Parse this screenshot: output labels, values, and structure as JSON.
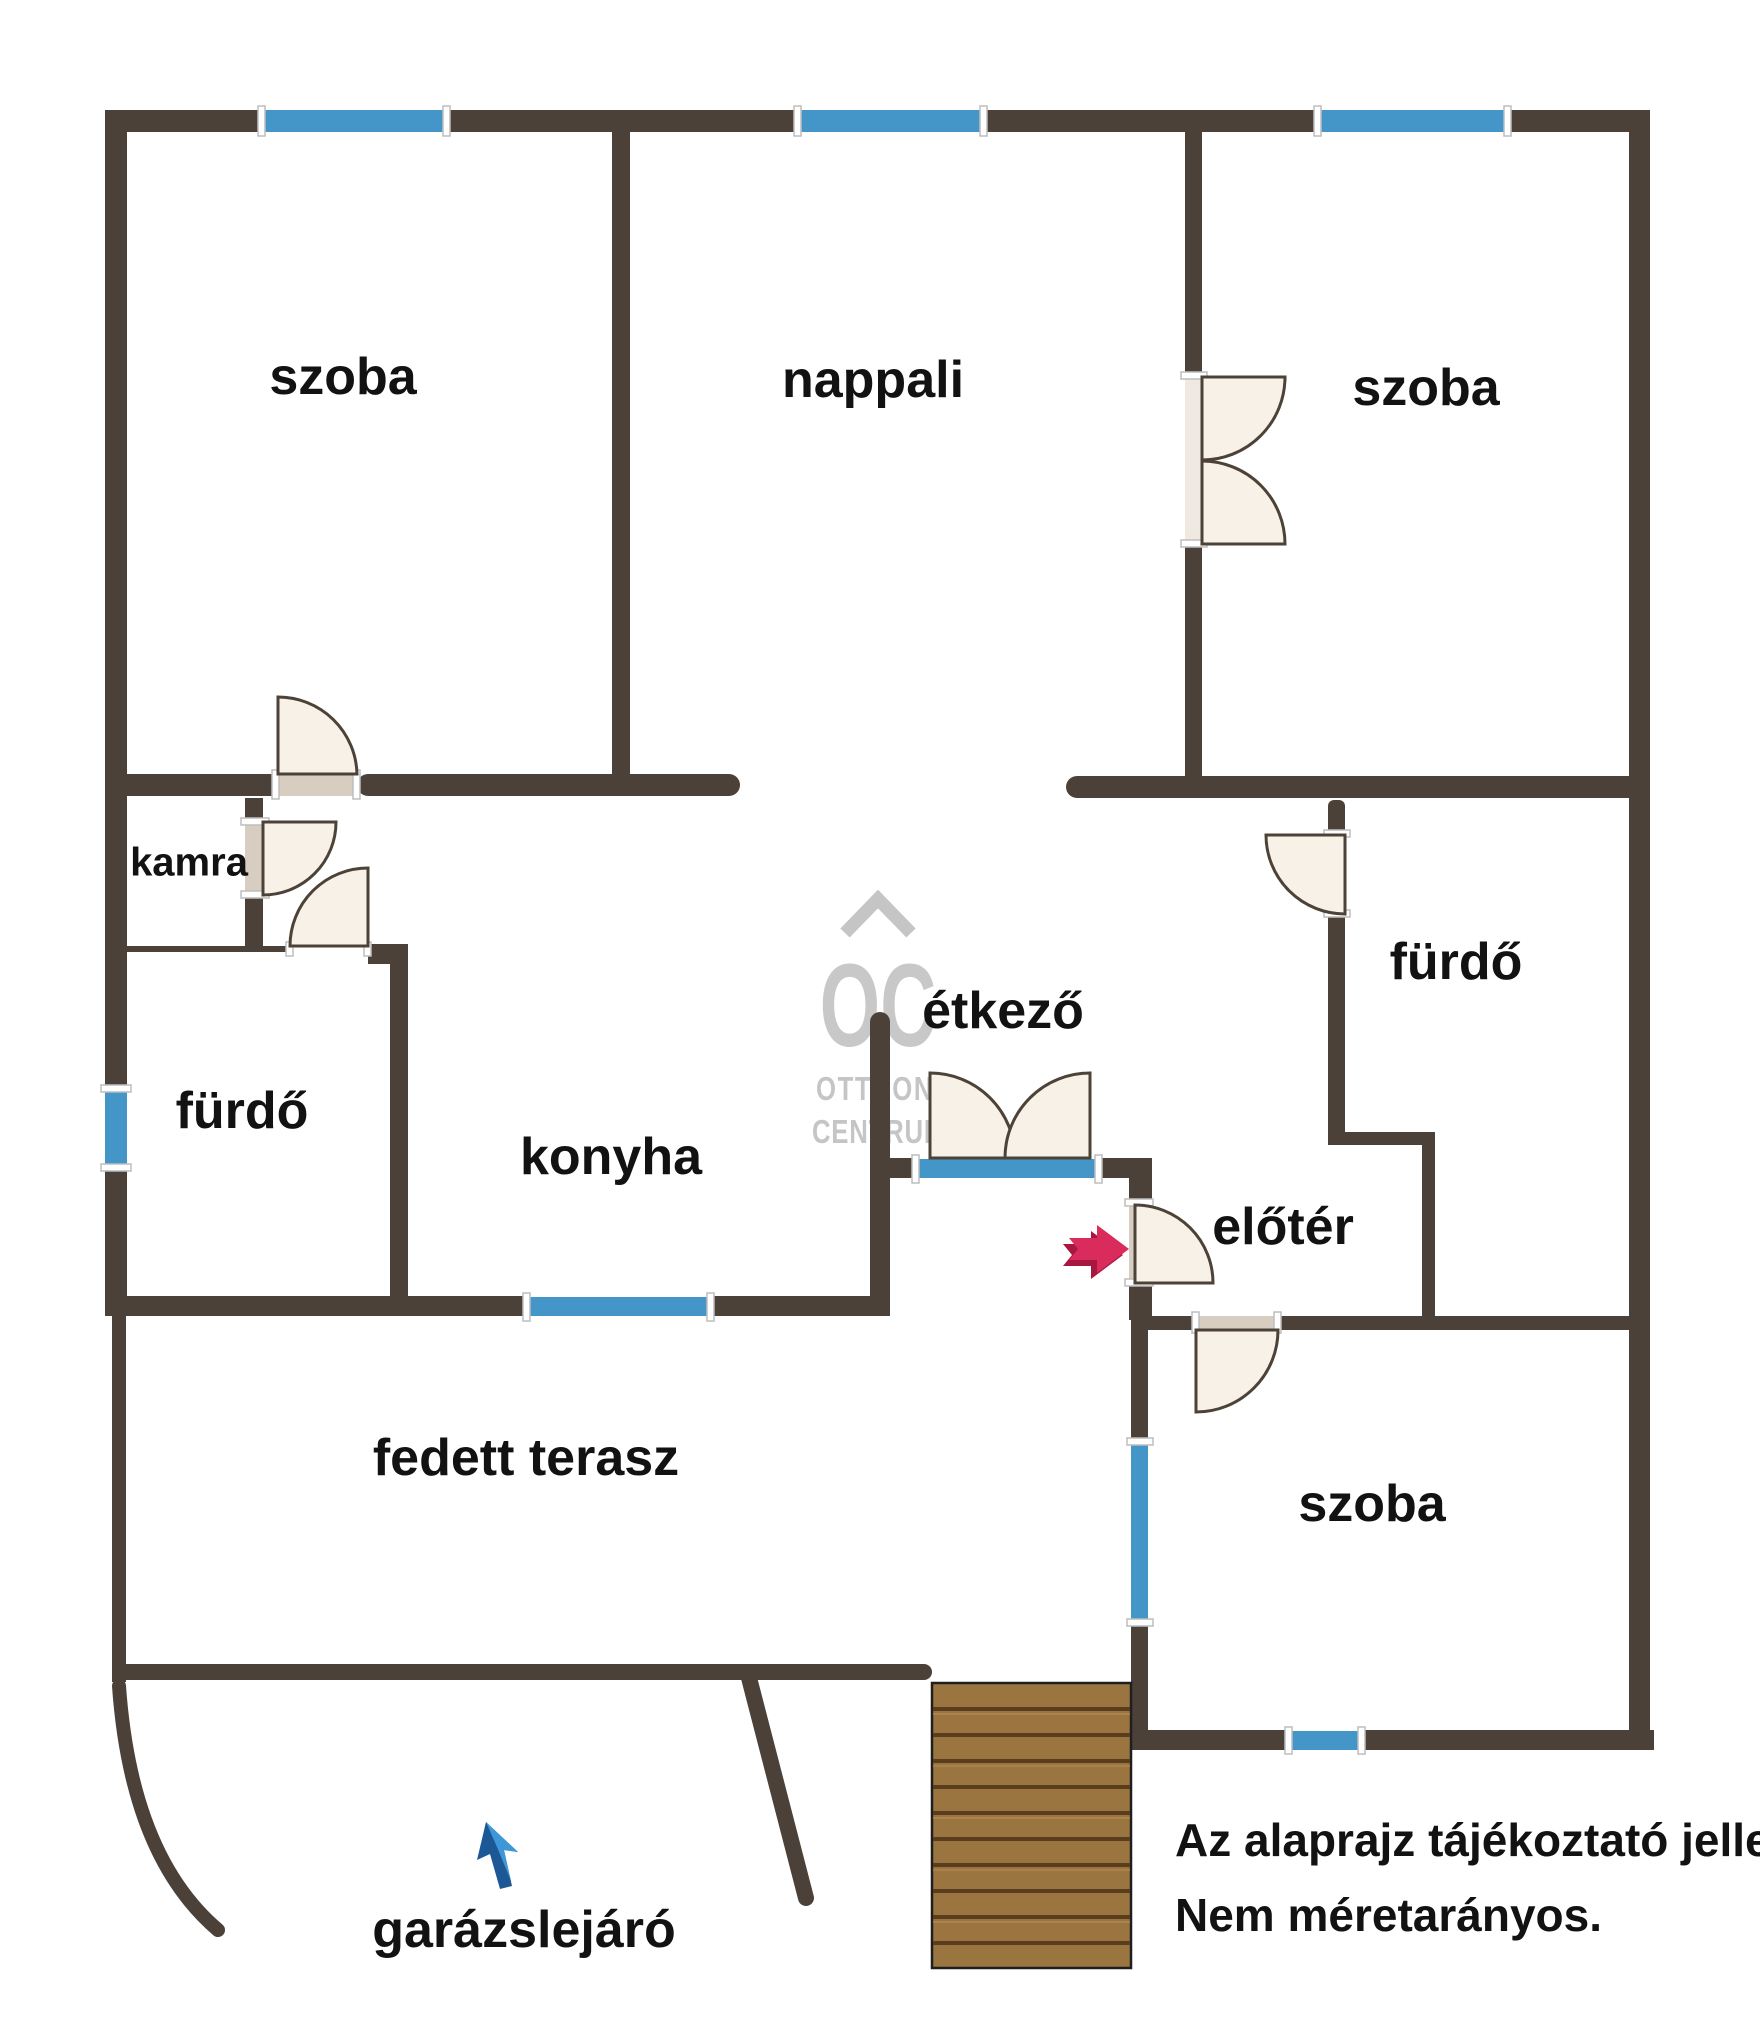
{
  "rooms": [
    {
      "label": "szoba"
    },
    {
      "label": "nappali"
    },
    {
      "label": "szoba"
    },
    {
      "label": "kamra"
    },
    {
      "label": "fürdő"
    },
    {
      "label": "konyha"
    },
    {
      "label": "étkező"
    },
    {
      "label": "fürdő"
    },
    {
      "label": "előtér"
    },
    {
      "label": "fedett terasz"
    },
    {
      "label": "szoba"
    },
    {
      "label": "garázslejáró"
    }
  ],
  "watermark": {
    "initials": "OC",
    "line1": "OTTHON",
    "line2": "CENTRUM"
  },
  "disclaimer": {
    "line1": "Az alaprajz tájékoztató jellegű.",
    "line2": "Nem méretarányos."
  },
  "colors": {
    "wall": "#4C4138",
    "window_blue": "#4496C8",
    "door_leaf": "#F8F1E7",
    "door_outline": "#4D4237",
    "threshold": "#D8CDC1",
    "stairs_wood": "#9B7540",
    "stairs_tread": "#5A3D1E",
    "arrow_red": "#D92B5C",
    "arrow_red_dark": "#A8173F",
    "arrow_blue_dark": "#1C5796",
    "arrow_blue_light": "#3E97D8",
    "watermark_gray": "#C5C5C5"
  }
}
